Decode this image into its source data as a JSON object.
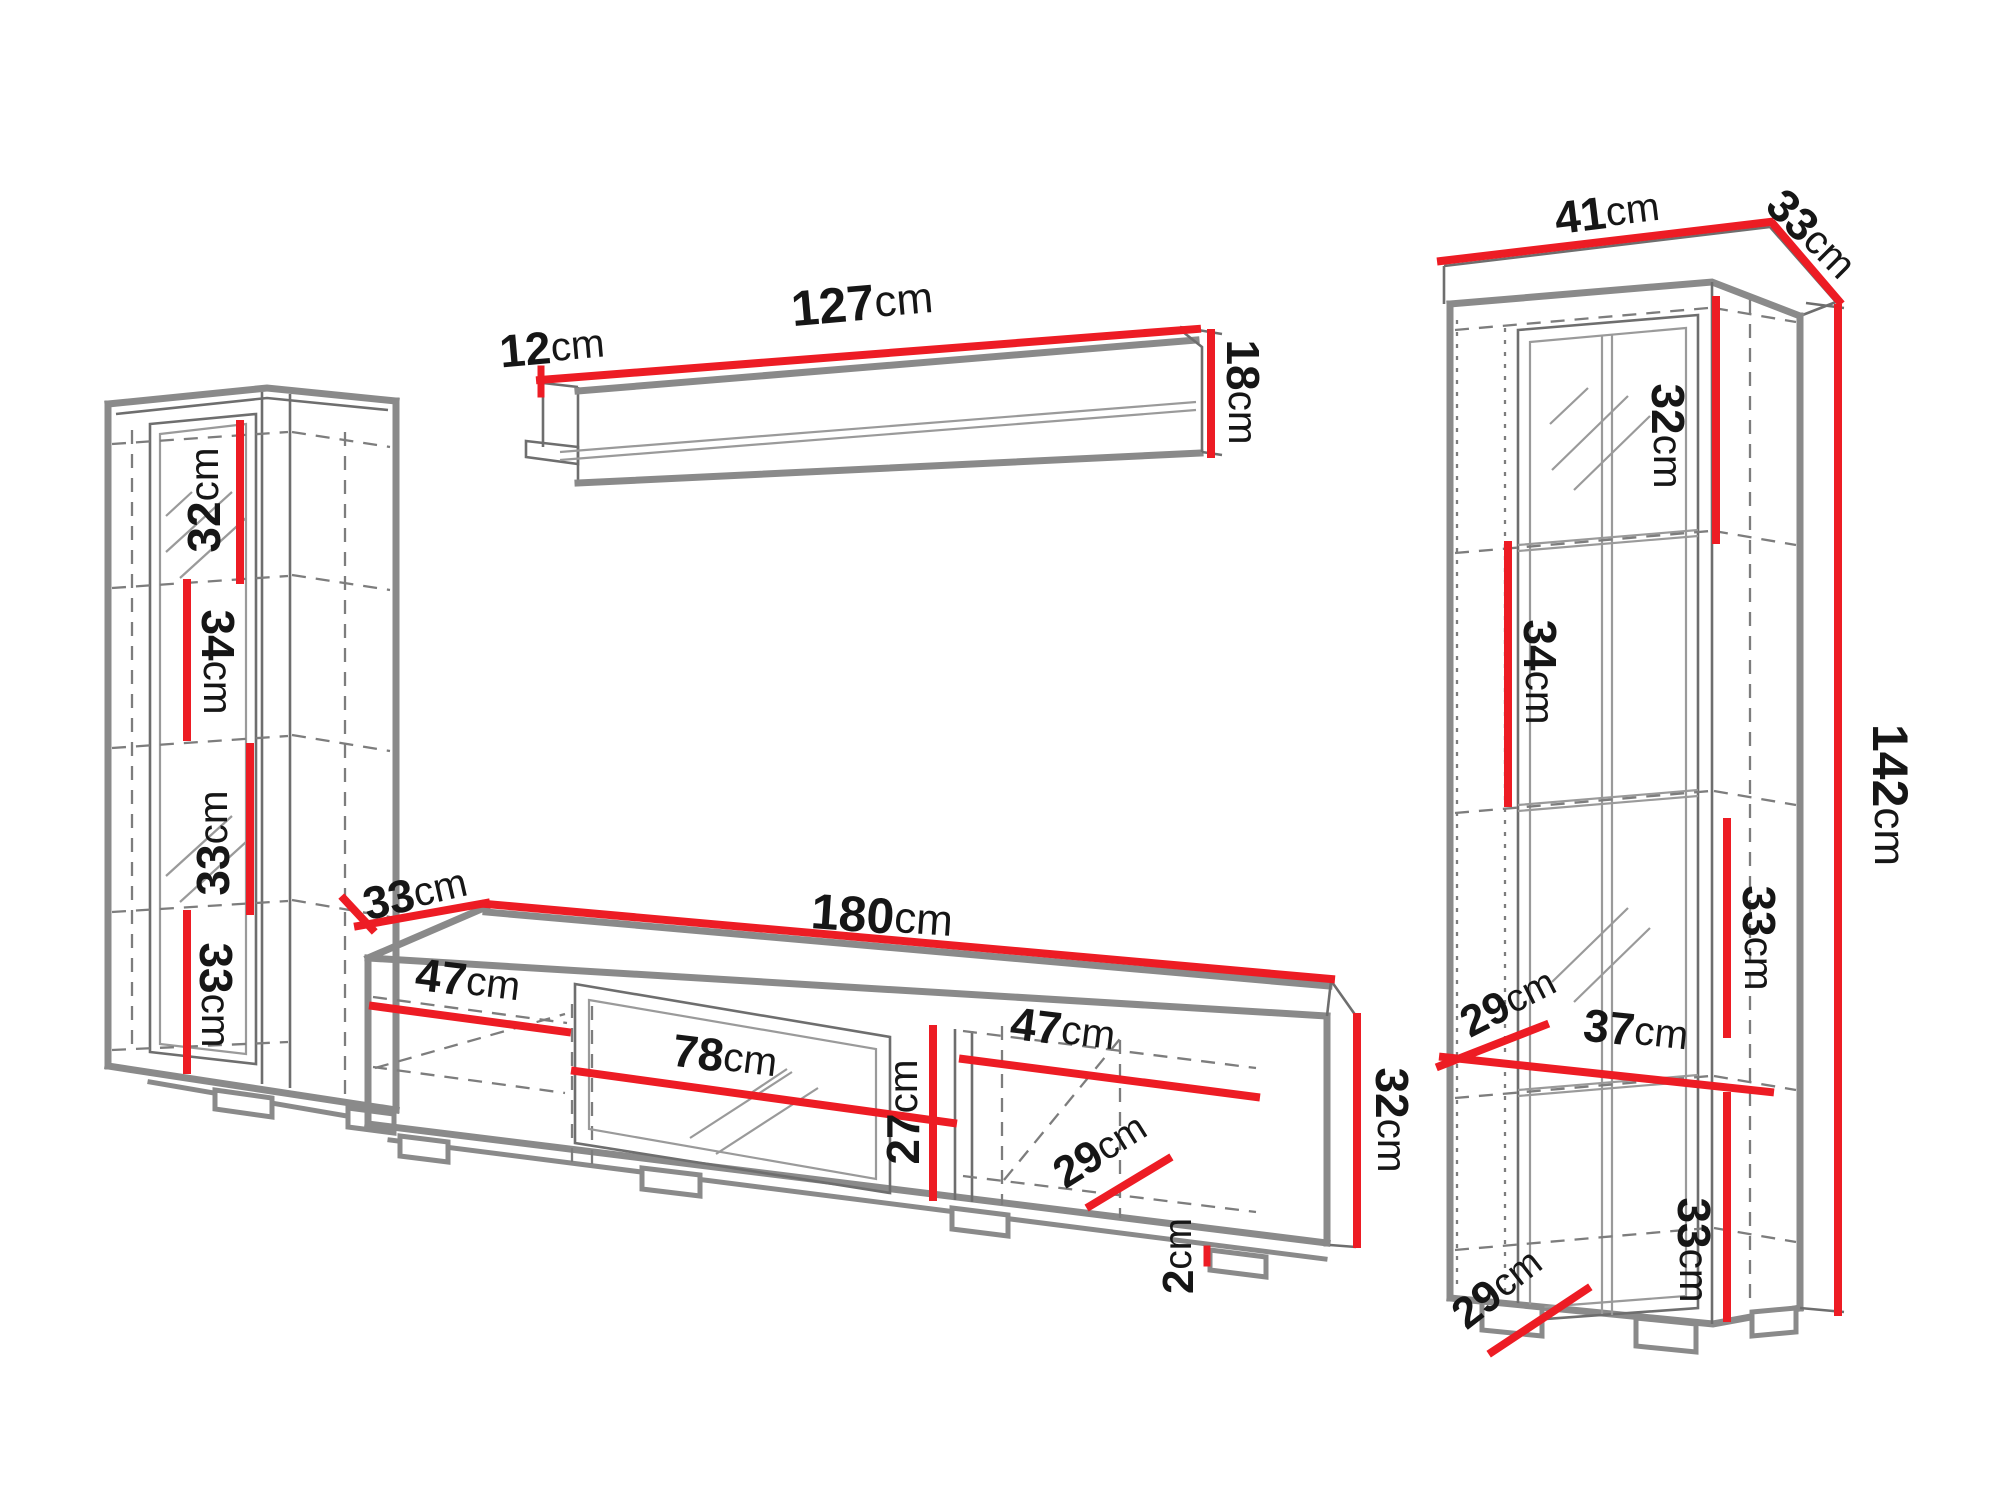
{
  "diagram": {
    "type": "furniture-dimension-diagram",
    "units": "cm",
    "colors": {
      "background": "#ffffff",
      "dimension_line": "#ed1c24",
      "outline": "#8a8a8a",
      "thin_line": "#6e6e6e",
      "hidden_line": "#7d7d7d",
      "label_text": "#161616"
    }
  },
  "pieces": [
    {
      "id": "left-column-cabinet",
      "dimensions": [
        {
          "id": "lc-32",
          "value": "32",
          "unit": "cm",
          "x": 204,
          "y": 500,
          "rotate": -90,
          "size": 46
        },
        {
          "id": "lc-34",
          "value": "34",
          "unit": "cm",
          "x": 218,
          "y": 662,
          "rotate": 90,
          "size": 46
        },
        {
          "id": "lc-33a",
          "value": "33",
          "unit": "cm",
          "x": 213,
          "y": 843,
          "rotate": -90,
          "size": 46
        },
        {
          "id": "lc-33b",
          "value": "33",
          "unit": "cm",
          "x": 216,
          "y": 995,
          "rotate": 90,
          "size": 46
        }
      ]
    },
    {
      "id": "wall-shelf",
      "dimensions": [
        {
          "id": "ws-12",
          "value": "12",
          "unit": "cm",
          "x": 552,
          "y": 347,
          "rotate": -5,
          "size": 46
        },
        {
          "id": "ws-127",
          "value": "127",
          "unit": "cm",
          "x": 862,
          "y": 303,
          "rotate": -5,
          "size": 50
        },
        {
          "id": "ws-18",
          "value": "18",
          "unit": "cm",
          "x": 1243,
          "y": 392,
          "rotate": 90,
          "size": 46
        }
      ]
    },
    {
      "id": "tv-stand",
      "dimensions": [
        {
          "id": "tv-33",
          "value": "33",
          "unit": "cm",
          "x": 415,
          "y": 893,
          "rotate": -13,
          "size": 46
        },
        {
          "id": "tv-180",
          "value": "180",
          "unit": "cm",
          "x": 882,
          "y": 916,
          "rotate": 4,
          "size": 50
        },
        {
          "id": "tv-47l",
          "value": "47",
          "unit": "cm",
          "x": 468,
          "y": 980,
          "rotate": 7,
          "size": 46
        },
        {
          "id": "tv-78",
          "value": "78",
          "unit": "cm",
          "x": 725,
          "y": 1056,
          "rotate": 7,
          "size": 46
        },
        {
          "id": "tv-27",
          "value": "27",
          "unit": "cm",
          "x": 903,
          "y": 1112,
          "rotate": -90,
          "size": 46
        },
        {
          "id": "tv-47r",
          "value": "47",
          "unit": "cm",
          "x": 1063,
          "y": 1029,
          "rotate": 7,
          "size": 46
        },
        {
          "id": "tv-29",
          "value": "29",
          "unit": "cm",
          "x": 1100,
          "y": 1150,
          "rotate": -32,
          "size": 44
        },
        {
          "id": "tv-2",
          "value": "2",
          "unit": "cm",
          "x": 1178,
          "y": 1256,
          "rotate": -90,
          "size": 44
        },
        {
          "id": "tv-32",
          "value": "32",
          "unit": "cm",
          "x": 1392,
          "y": 1120,
          "rotate": 90,
          "size": 46
        }
      ]
    },
    {
      "id": "display-cabinet",
      "dimensions": [
        {
          "id": "dc-41",
          "value": "41",
          "unit": "cm",
          "x": 1607,
          "y": 212,
          "rotate": -7,
          "size": 46
        },
        {
          "id": "dc-33d",
          "value": "33",
          "unit": "cm",
          "x": 1812,
          "y": 234,
          "rotate": 45,
          "size": 46
        },
        {
          "id": "dc-32",
          "value": "32",
          "unit": "cm",
          "x": 1668,
          "y": 436,
          "rotate": 90,
          "size": 46
        },
        {
          "id": "dc-34",
          "value": "34",
          "unit": "cm",
          "x": 1540,
          "y": 672,
          "rotate": 90,
          "size": 46
        },
        {
          "id": "dc-142",
          "value": "142",
          "unit": "cm",
          "x": 1890,
          "y": 795,
          "rotate": 90,
          "size": 50
        },
        {
          "id": "dc-33a",
          "value": "33",
          "unit": "cm",
          "x": 1759,
          "y": 938,
          "rotate": 90,
          "size": 46
        },
        {
          "id": "dc-29a",
          "value": "29",
          "unit": "cm",
          "x": 1508,
          "y": 1002,
          "rotate": -27,
          "size": 44
        },
        {
          "id": "dc-37",
          "value": "37",
          "unit": "cm",
          "x": 1636,
          "y": 1030,
          "rotate": 6,
          "size": 46
        },
        {
          "id": "dc-33b",
          "value": "33",
          "unit": "cm",
          "x": 1694,
          "y": 1250,
          "rotate": 90,
          "size": 46
        },
        {
          "id": "dc-29b",
          "value": "29",
          "unit": "cm",
          "x": 1497,
          "y": 1288,
          "rotate": -38,
          "size": 44
        }
      ]
    }
  ]
}
